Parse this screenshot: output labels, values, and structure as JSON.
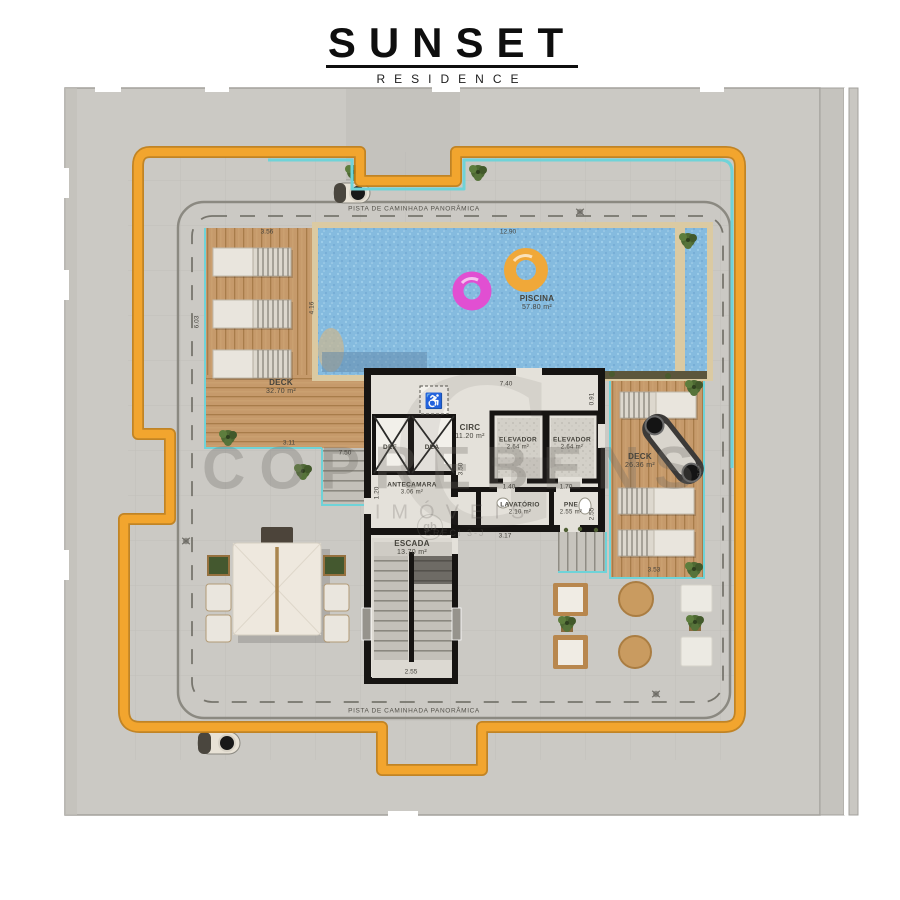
{
  "logo": {
    "title": "SUNSET",
    "subtitle": "RESIDENCE"
  },
  "walkway": {
    "top": "PISTA DE CAMINHADA PANORÂMICA",
    "bottom": "PISTA DE CAMINHADA PANORÂMICA"
  },
  "rooms": {
    "piscina": {
      "name": "PISCINA",
      "area": "57.80 m²"
    },
    "deck_left": {
      "name": "DECK",
      "area": "32.70 m²"
    },
    "deck_right": {
      "name": "DECK",
      "area": "26.36 m²"
    },
    "circ": {
      "name": "CIRC",
      "area": "11.20 m²"
    },
    "elevador_1": {
      "name": "ELEVADOR",
      "area": "2.64 m²"
    },
    "elevador_2": {
      "name": "ELEVADOR",
      "area": "2.64 m²"
    },
    "antecamara": {
      "name": "ANTECAMARA",
      "area": "3.06 m²"
    },
    "lavatorio": {
      "name": "LAVATÓRIO",
      "area": "2.10 m²"
    },
    "pne": {
      "name": "PNE",
      "area": "2.55 m²"
    },
    "escada": {
      "name": "ESCADA",
      "area": "13.70 m²"
    },
    "def": {
      "name": "DEF"
    },
    "dea": {
      "name": "DEA"
    }
  },
  "icons": {
    "wheelchair": "♿"
  },
  "watermark": {
    "brand": "COPREBENS",
    "line2": "IMÓVEIS",
    "line3": "CRECI 3-J",
    "monogram": "gb",
    "ghost": "G"
  },
  "dimensions": [
    {
      "text": "3.56",
      "x": 267,
      "y": 232,
      "rot": "h"
    },
    {
      "text": "12.90",
      "x": 508,
      "y": 232,
      "rot": "h"
    },
    {
      "text": "6.03",
      "x": 197,
      "y": 322,
      "rot": "v"
    },
    {
      "text": "4.16",
      "x": 312,
      "y": 308,
      "rot": "v"
    },
    {
      "text": "3.11",
      "x": 289,
      "y": 443,
      "rot": "h"
    },
    {
      "text": "7.50",
      "x": 345,
      "y": 453,
      "rot": "h"
    },
    {
      "text": "1.20",
      "x": 377,
      "y": 493,
      "rot": "v"
    },
    {
      "text": "7.40",
      "x": 506,
      "y": 384,
      "rot": "h"
    },
    {
      "text": "0.91",
      "x": 592,
      "y": 399,
      "rot": "v"
    },
    {
      "text": "3.50",
      "x": 461,
      "y": 469,
      "rot": "v"
    },
    {
      "text": "1.40",
      "x": 509,
      "y": 487,
      "rot": "h"
    },
    {
      "text": "1.70",
      "x": 566,
      "y": 487,
      "rot": "h"
    },
    {
      "text": "2.55",
      "x": 592,
      "y": 514,
      "rot": "v"
    },
    {
      "text": "3.17",
      "x": 505,
      "y": 536,
      "rot": "h"
    },
    {
      "text": "2.55",
      "x": 411,
      "y": 672,
      "rot": "h"
    },
    {
      "text": "3.53",
      "x": 654,
      "y": 570,
      "rot": "h"
    },
    {
      "text": "2.91",
      "x": 700,
      "y": 470,
      "rot": "v"
    }
  ],
  "colors": {
    "accent_path": "#f2a52e",
    "path_border": "#c07c14",
    "teal": "#6fd3d8",
    "pool_water": "#85bbdf",
    "wood": "#c69a6b",
    "slab": "#cbc9c4",
    "wall": "#161412",
    "float_pink": "#e14fd2",
    "float_orange": "#f0a839",
    "watermark_gray": "#6c6a63"
  }
}
